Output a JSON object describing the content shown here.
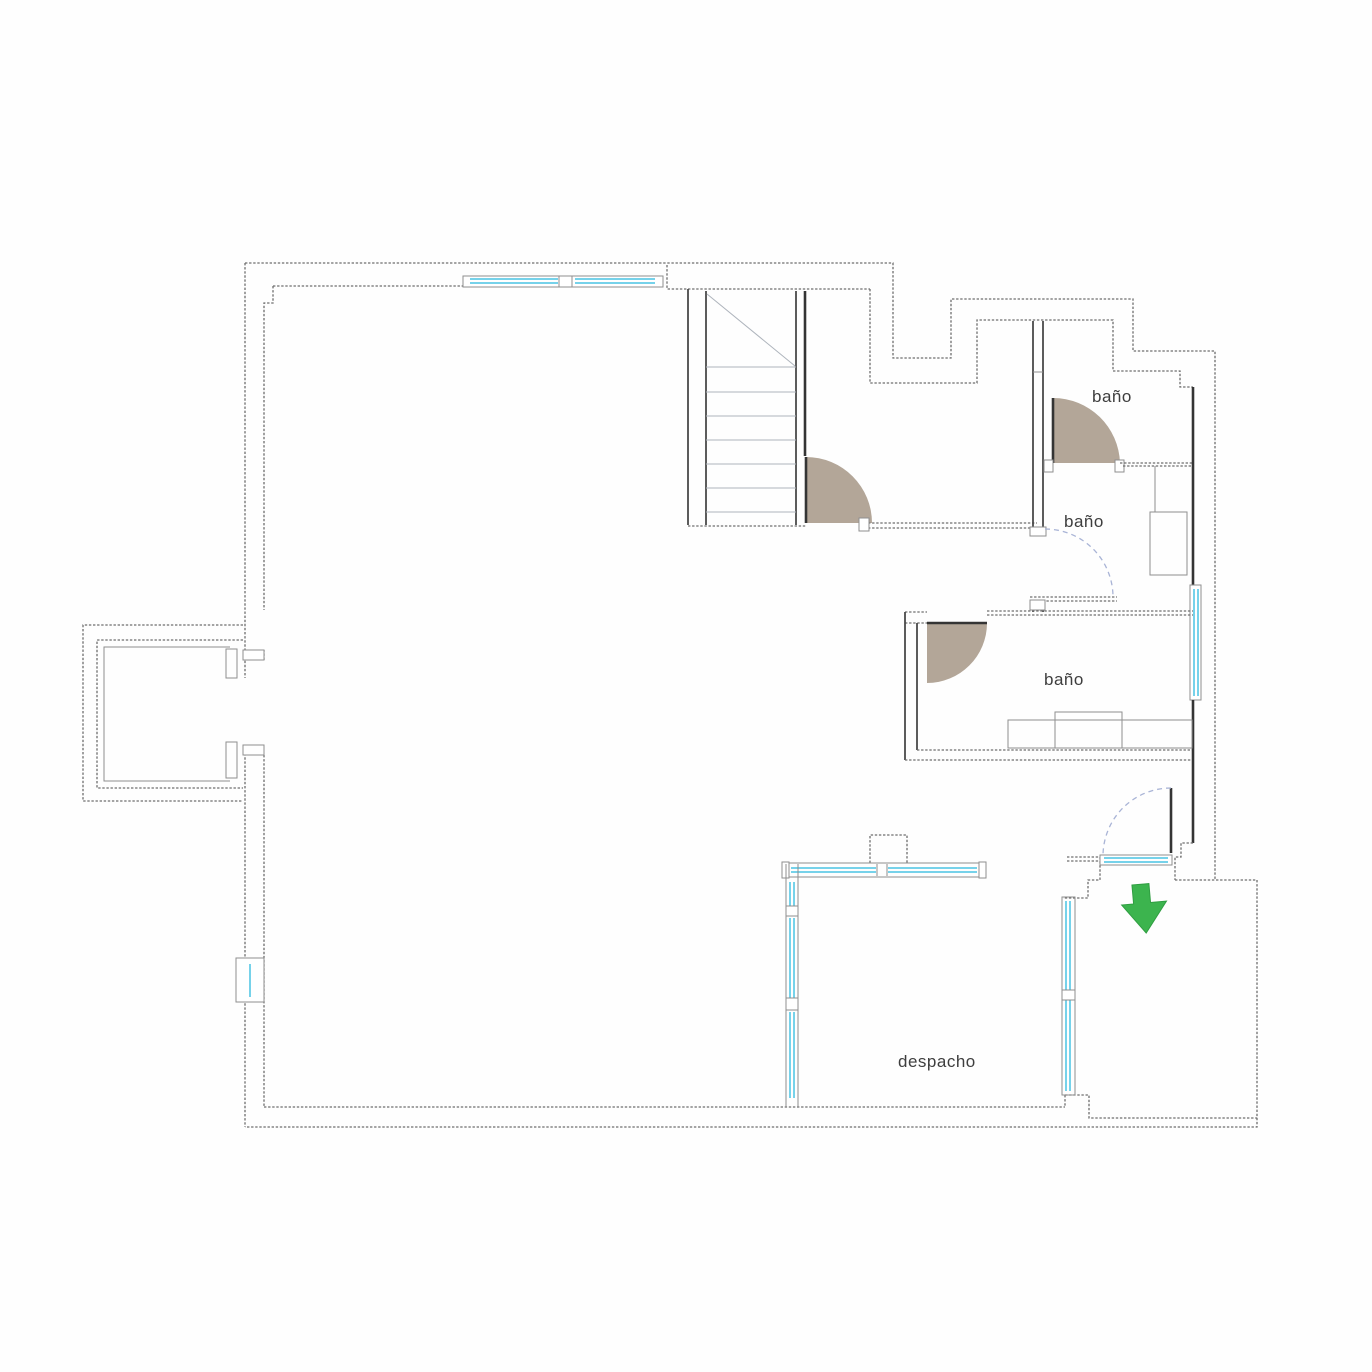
{
  "plan": {
    "type": "floor-plan",
    "rooms": [
      {
        "id": "bathroom-top",
        "label": "baño"
      },
      {
        "id": "bathroom-middle",
        "label": "baño"
      },
      {
        "id": "bathroom-lower",
        "label": "baño"
      },
      {
        "id": "office",
        "label": "despacho"
      }
    ],
    "icons": [
      {
        "name": "entrance-arrow-icon"
      }
    ],
    "colors": {
      "wall": "#4a4a4a",
      "glazing": "#76d2ea",
      "door_leaf_fill": "#b3a698",
      "door_swing_arc": "#a9b4d6",
      "entrance_arrow": "#3cb44e"
    }
  }
}
